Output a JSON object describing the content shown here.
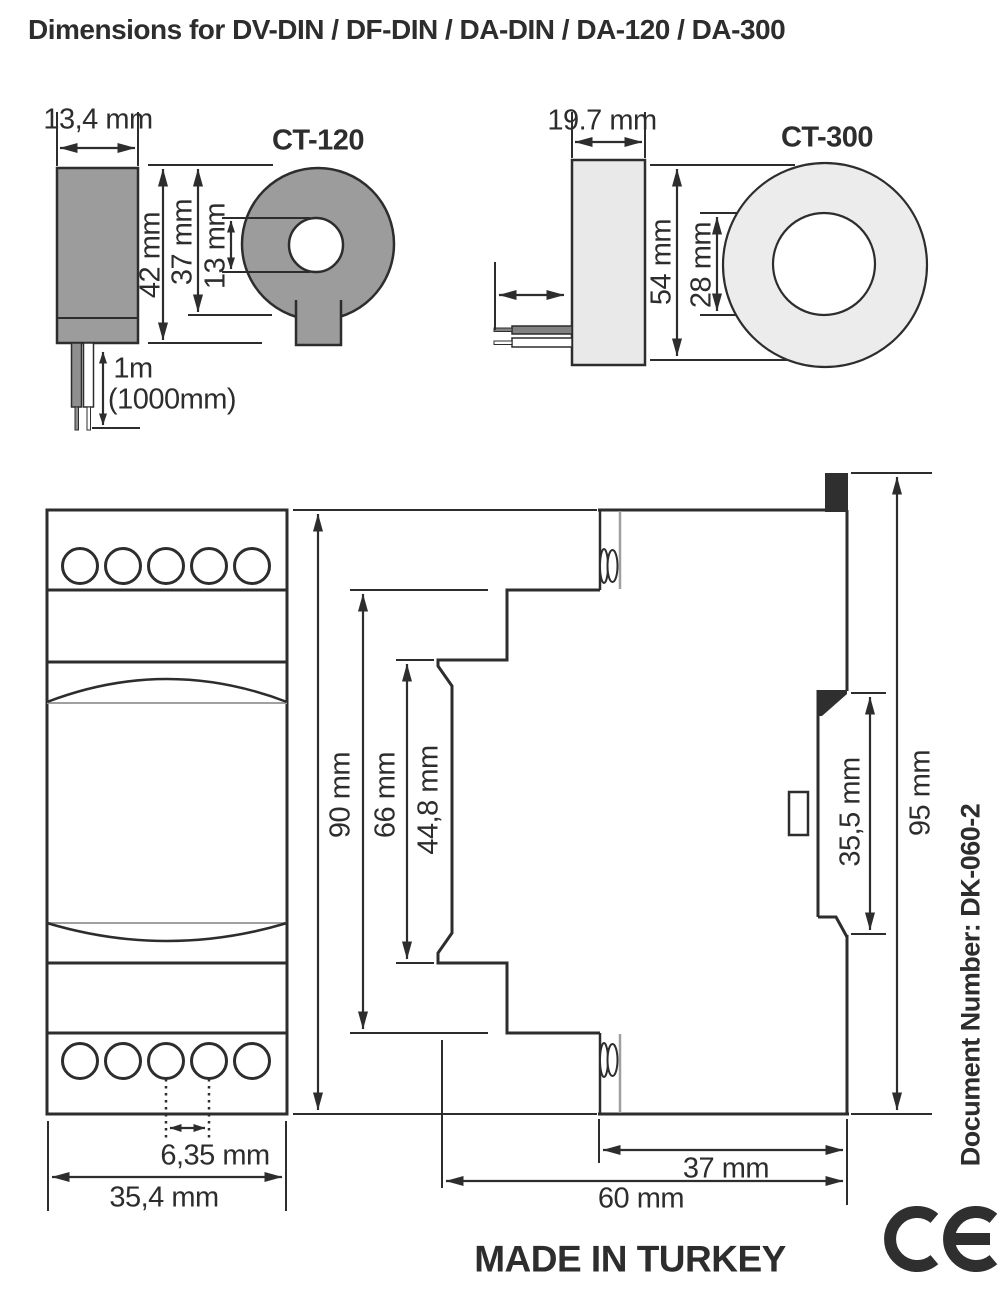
{
  "title": "Dimensions for DV-DIN / DF-DIN / DA-DIN / DA-120 / DA-300",
  "ct120": {
    "name": "CT-120",
    "width": "13,4 mm",
    "height": "42 mm",
    "core_height": "37 mm",
    "hole": "13 mm",
    "cable": "1m",
    "cable_mm": "(1000mm)"
  },
  "ct300": {
    "name": "CT-300",
    "width": "19.7 mm",
    "height": "54 mm",
    "hole": "28 mm"
  },
  "module": {
    "height": "90 mm",
    "terminal_span": "66 mm",
    "label_area": "44,8 mm",
    "pitch": "6,35 mm",
    "width": "35,4 mm",
    "din_slot": "35,5 mm",
    "total_height": "95 mm",
    "rail_width": "37 mm",
    "depth": "60 mm"
  },
  "footer": {
    "origin": "MADE IN TURKEY",
    "document": "Document Number: DK-060-2"
  },
  "colors": {
    "line": "#2d2d2d",
    "ct120_fill": "#9c9c9c",
    "ct300_fill": "#e9e9e9",
    "gray_accent": "#a0a0a0"
  }
}
